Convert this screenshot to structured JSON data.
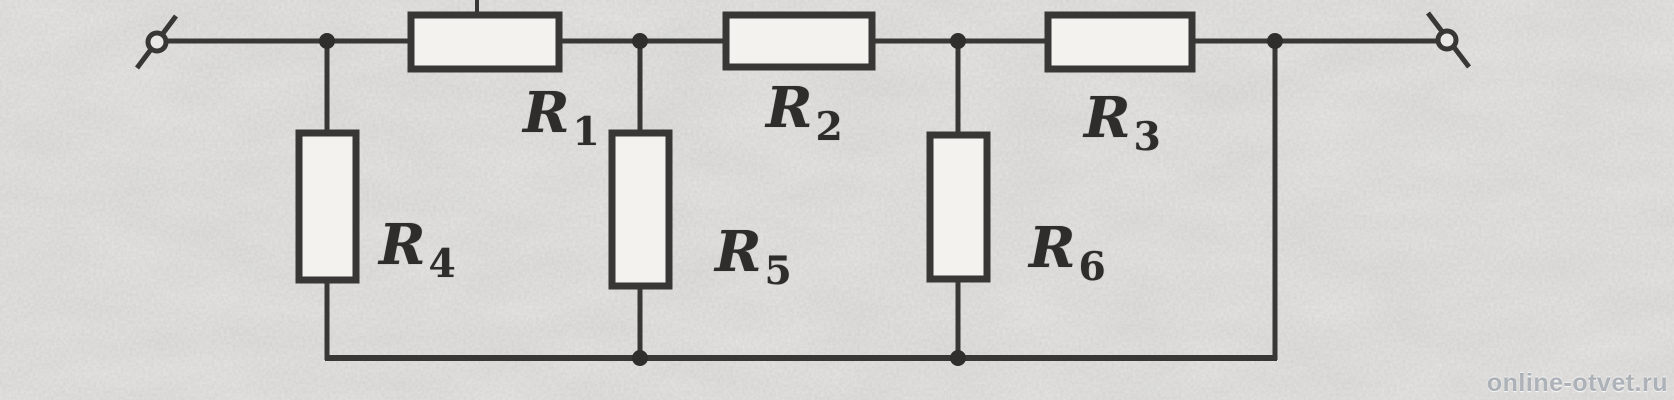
{
  "diagram": {
    "kind": "resistor-ladder-circuit-schematic",
    "resistors": [
      {
        "name": "R1",
        "base": "R",
        "sub": "1",
        "orientation": "horizontal"
      },
      {
        "name": "R2",
        "base": "R",
        "sub": "2",
        "orientation": "horizontal"
      },
      {
        "name": "R3",
        "base": "R",
        "sub": "3",
        "orientation": "horizontal"
      },
      {
        "name": "R4",
        "base": "R",
        "sub": "4",
        "orientation": "vertical"
      },
      {
        "name": "R5",
        "base": "R",
        "sub": "5",
        "orientation": "vertical"
      },
      {
        "name": "R6",
        "base": "R",
        "sub": "6",
        "orientation": "vertical"
      }
    ],
    "terminals": [
      {
        "name": "left-terminal"
      },
      {
        "name": "right-terminal"
      }
    ],
    "colors": {
      "line": "#383735",
      "background": "#e9e8e6",
      "resistor_fill": "#f3f2ef"
    }
  },
  "watermark": {
    "text": "online-otvet.ru"
  }
}
